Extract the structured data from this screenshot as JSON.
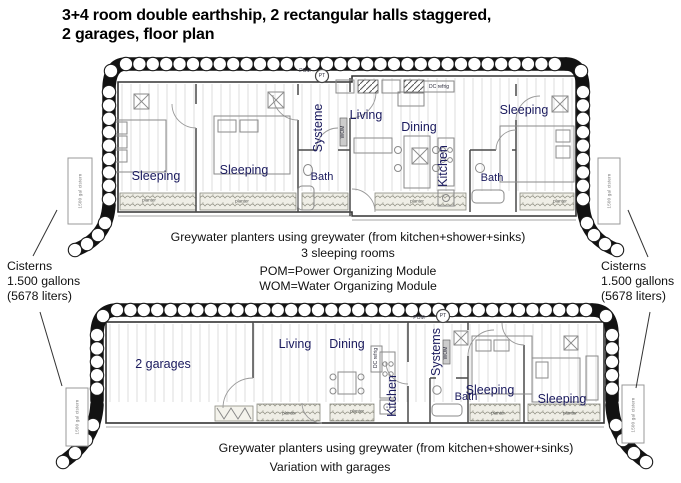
{
  "title": {
    "line1": "3+4 room double earthship, 2 rectangular halls staggered,",
    "line2": "2 garages, floor plan"
  },
  "colors": {
    "room_label": "#1a1a5e",
    "line_art": "#1a1a1a",
    "wall": "#4a4a4a",
    "plank": "#d6d6d6",
    "planter_fill": "#efeee6"
  },
  "upper_plan": {
    "name": "upper-floor-plan",
    "labels": [
      {
        "name": "room-label-sleeping-1",
        "text": "Sleeping",
        "x": 156,
        "y": 176,
        "kind": "room"
      },
      {
        "name": "room-label-sleeping-2",
        "text": "Sleeping",
        "x": 244,
        "y": 170,
        "kind": "room"
      },
      {
        "name": "room-label-bath-1",
        "text": "Bath",
        "x": 322,
        "y": 177,
        "kind": "room-sm"
      },
      {
        "name": "room-label-systems-1",
        "text": "Systeme",
        "x": 318,
        "y": 128,
        "kind": "room",
        "vertical": true
      },
      {
        "name": "room-label-living-1",
        "text": "Living",
        "x": 366,
        "y": 115,
        "kind": "room"
      },
      {
        "name": "room-label-dining-1",
        "text": "Dining",
        "x": 419,
        "y": 127,
        "kind": "room"
      },
      {
        "name": "room-label-kitchen-1",
        "text": "Kitchen",
        "x": 443,
        "y": 166,
        "kind": "room",
        "vertical": true
      },
      {
        "name": "room-label-bath-2",
        "text": "Bath",
        "x": 492,
        "y": 178,
        "kind": "room-sm"
      },
      {
        "name": "room-label-sleeping-3",
        "text": "Sleeping",
        "x": 524,
        "y": 110,
        "kind": "room"
      },
      {
        "name": "equipment-label-pom-1",
        "text": "POM",
        "x": 305,
        "y": 71,
        "kind": "tiny"
      },
      {
        "name": "equipment-label-pt-1",
        "text": "PT",
        "x": 322,
        "y": 76,
        "kind": "tiny"
      },
      {
        "name": "equipment-label-dc-refrig-1",
        "text": "DC refrig",
        "x": 439,
        "y": 87,
        "kind": "tiny"
      },
      {
        "name": "equipment-label-wom-1",
        "text": "WOM",
        "x": 343,
        "y": 132,
        "kind": "tiny",
        "vertical": true
      },
      {
        "name": "planter-label-1",
        "text": "planter",
        "x": 149,
        "y": 200,
        "kind": "planter"
      },
      {
        "name": "planter-label-2",
        "text": "planter",
        "x": 242,
        "y": 201,
        "kind": "planter"
      },
      {
        "name": "planter-label-3",
        "text": "planter",
        "x": 417,
        "y": 201,
        "kind": "planter"
      },
      {
        "name": "planter-label-4",
        "text": "planter",
        "x": 560,
        "y": 201,
        "kind": "planter"
      },
      {
        "name": "cistern-label-upper-left",
        "text": "1500 gal cistern",
        "x": 80,
        "y": 191,
        "kind": "cistern",
        "vertical": true
      },
      {
        "name": "cistern-label-upper-right",
        "text": "1500 gal cistern",
        "x": 609,
        "y": 191,
        "kind": "cistern",
        "vertical": true
      }
    ]
  },
  "lower_plan": {
    "name": "lower-floor-plan",
    "labels": [
      {
        "name": "room-label-garages",
        "text": "2 garages",
        "x": 163,
        "y": 364,
        "kind": "room"
      },
      {
        "name": "room-label-living-2",
        "text": "Living",
        "x": 295,
        "y": 344,
        "kind": "room"
      },
      {
        "name": "room-label-dining-2",
        "text": "Dining",
        "x": 347,
        "y": 344,
        "kind": "room"
      },
      {
        "name": "room-label-kitchen-2",
        "text": "Kitchen",
        "x": 392,
        "y": 396,
        "kind": "room",
        "vertical": true
      },
      {
        "name": "room-label-systems-2",
        "text": "Systems",
        "x": 436,
        "y": 352,
        "kind": "room",
        "vertical": true
      },
      {
        "name": "room-label-bath-3",
        "text": "Bath",
        "x": 466,
        "y": 397,
        "kind": "room-sm"
      },
      {
        "name": "room-label-sleeping-4",
        "text": "Sleeping",
        "x": 490,
        "y": 390,
        "kind": "room"
      },
      {
        "name": "room-label-sleeping-5",
        "text": "Sleeping",
        "x": 562,
        "y": 399,
        "kind": "room"
      },
      {
        "name": "equipment-label-pom-2",
        "text": "POM",
        "x": 419,
        "y": 318,
        "kind": "tiny"
      },
      {
        "name": "equipment-label-pt-2",
        "text": "PT",
        "x": 443,
        "y": 316,
        "kind": "tiny"
      },
      {
        "name": "equipment-label-wom-2",
        "text": "WOM",
        "x": 446,
        "y": 353,
        "kind": "tiny",
        "vertical": true
      },
      {
        "name": "equipment-label-dc-refrig-2",
        "text": "DC refrig",
        "x": 376,
        "y": 358,
        "kind": "tiny",
        "vertical": true
      },
      {
        "name": "planter-label-5",
        "text": "planter",
        "x": 289,
        "y": 413,
        "kind": "planter"
      },
      {
        "name": "planter-label-6",
        "text": "planter",
        "x": 357,
        "y": 411,
        "kind": "planter"
      },
      {
        "name": "planter-label-7",
        "text": "planter",
        "x": 498,
        "y": 413,
        "kind": "planter"
      },
      {
        "name": "planter-label-8",
        "text": "planter",
        "x": 570,
        "y": 413,
        "kind": "planter"
      },
      {
        "name": "cistern-label-lower-left",
        "text": "1500 gal cistern",
        "x": 77,
        "y": 417,
        "kind": "cistern",
        "vertical": true
      },
      {
        "name": "cistern-label-lower-right",
        "text": "1500 gal cistern",
        "x": 633,
        "y": 415,
        "kind": "cistern",
        "vertical": true
      }
    ]
  },
  "annotations": {
    "upper_caption_line1": "Greywater planters using greywater (from kitchen+shower+sinks)",
    "upper_caption_line2": "3 sleeping rooms",
    "module_definitions": {
      "pom": "POM=Power Organizing Module",
      "wom": "WOM=Water Organizing Module"
    },
    "lower_caption_line1": "Greywater planters using greywater (from kitchen+shower+sinks)",
    "lower_caption_line2": "Variation with garages",
    "cisterns_left": {
      "line1": "Cisterns",
      "line2": "1.500 gallons",
      "line3": "(5678 liters)"
    },
    "cisterns_right": {
      "line1": "Cisterns",
      "line2": "1.500 gallons",
      "line3": "(5678 liters)"
    }
  }
}
